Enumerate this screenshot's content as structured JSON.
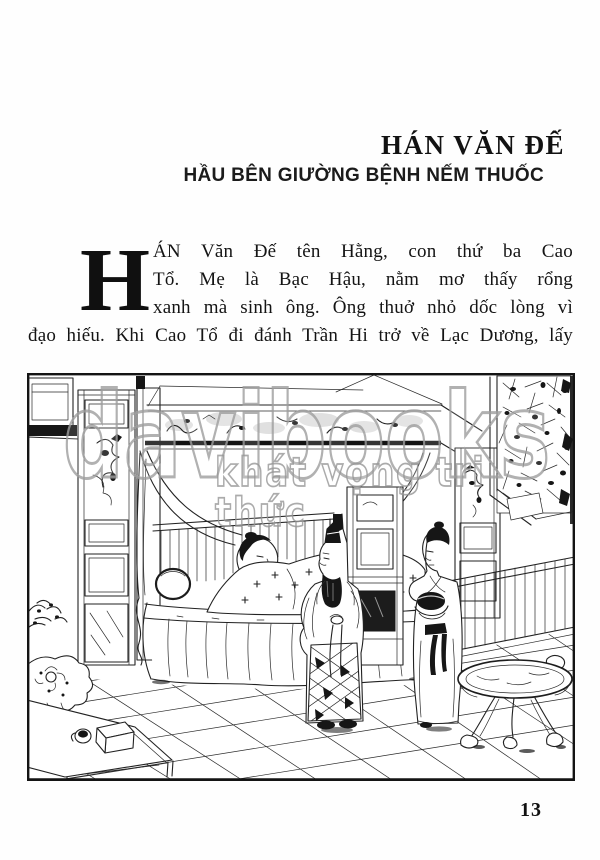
{
  "page": {
    "header": {
      "title": "HÁN VĂN ĐẾ",
      "subtitle": "HẦU BÊN GIƯỜNG BỆNH NẾM THUỐC"
    },
    "body": {
      "drop_cap": "H",
      "lines": [
        "ÁN Văn Đế tên Hằng, con thứ ba Cao",
        "Tổ. Mẹ là Bạc Hậu, nằm mơ thấy rổng",
        "xanh mà sinh ông. Ông thuở nhỏ dốc lòng vì",
        "đạo hiếu. Khi Cao Tổ đi đánh Trần Hi trở về Lạc Dương, lấy"
      ]
    },
    "page_number": "13"
  },
  "watermark": {
    "brand": "davibooks",
    "tagline": "khát vọng tri thức"
  },
  "illustration": {
    "alt": "Ink line drawing: a sick woman lies in a canopied bed while Hán Văn Đế in a tall cap stands at the bedside and an attendant holds a bowl of medicine; tiled floor, low table with box and cup, round pedestal table, lattice window and railing",
    "elements": [
      "window",
      "paneled-pillar",
      "canopy-bed",
      "curtains",
      "sick-person-in-bed",
      "emperor-figure",
      "attendant-with-bowl",
      "cabinet",
      "lattice-window",
      "railing",
      "tiled-floor",
      "low-table",
      "round-table",
      "rocks-and-plant"
    ]
  },
  "colors": {
    "ink": "#1a1a1a",
    "paper": "#ffffff",
    "watermark": "#9e9e9e"
  }
}
